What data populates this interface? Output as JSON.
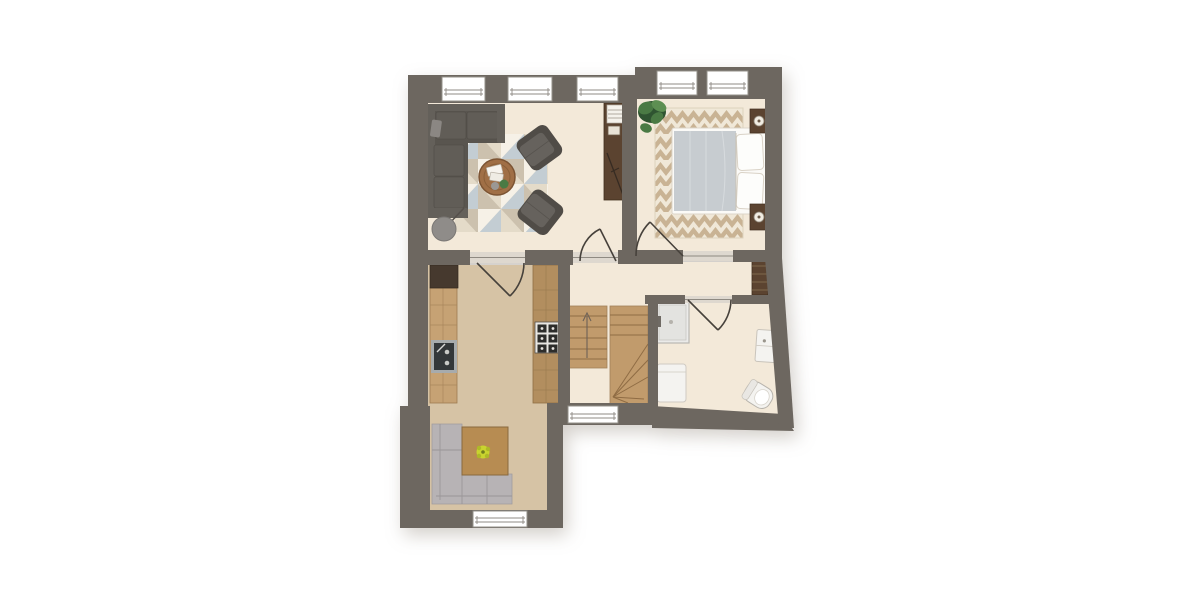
{
  "palette": {
    "background": "#ffffff",
    "wall": "#6d6760",
    "lintel": "#ded8cf",
    "jamb": "#8f8a82",
    "floor_cream": "#f3e9d9",
    "floor_tan": "#d6c3a5",
    "window_white": "#ffffff",
    "window_frame": "#94908a",
    "door_stroke": "#46413b",
    "stair_wood": "#c19b6c",
    "stair_line": "#8f6c44",
    "counter_wood": "#c6a274",
    "island_wood": "#b28e5f",
    "cabinet_dark": "#46392e",
    "sink_steel": "#a7abad",
    "sink_dark": "#33373a",
    "stove_panel": "#e8e6e2",
    "stove_dark": "#2d2d2b",
    "walnut": "#5b4330",
    "walnut_line": "#8a7356",
    "sofa_dark": "#59554f",
    "sofa_mid": "#615d57",
    "sofa_light": "#64605a",
    "sofa_pad": "#8b8783",
    "armchair_dark": "#504c47",
    "armchair_seat": "#66625d",
    "rug_white": "#f6f1e7",
    "rug_cream": "#e4dbc9",
    "rug_taupe": "#ccc1ae",
    "rug_blue": "#c3cdd3",
    "table_wood": "#a06f46",
    "table_edge": "#7c5433",
    "chevron_cream": "#f0e8d8",
    "chevron_beige": "#c9b394",
    "bed_frame": "#fbfaf7",
    "bed_frame_edge": "#dcd5c9",
    "duvet": "#c7ccd0",
    "duvet_fold": "#d7dbde",
    "pillow": "#fdfdfb",
    "bench_gray": "#b7b3b5",
    "bench_line": "#9a9698",
    "nook_table": "#b78c52",
    "flower_yellow": "#c9d42f",
    "flower_dark": "#717e1d",
    "plant_dark": "#2f5431",
    "plant_mid": "#4a7a44",
    "plant_light": "#5d8f52",
    "appliance_white": "#f4f3f0",
    "appliance_line": "#cfcac2",
    "fixture_fill": "#ebebe9",
    "fixture_stroke": "#bfbab2",
    "mixer_dark": "#6f6a64",
    "lamp_gray": "#8f8c89",
    "lamp_stem": "#55504b",
    "lamp_white": "#f1ece2",
    "lamp_dot": "#6b5b4a",
    "arrow": "#6d6257"
  },
  "plan": {
    "type": "apartment-floor-plan-top-view",
    "rooms": [
      "living-room",
      "bedroom",
      "kitchen",
      "dining-nook",
      "hallway",
      "stairwell",
      "bathroom"
    ],
    "window_count": 7,
    "door_count": 4,
    "furniture": {
      "living_room": [
        "corner-sofa",
        "triangle-pattern-rug",
        "round-coffee-table",
        "armchair-upper",
        "armchair-lower",
        "floor-lamp",
        "console-shelf"
      ],
      "bedroom": [
        "chevron-rug",
        "double-bed",
        "nightstand-upper",
        "nightstand-lower",
        "potted-plant"
      ],
      "kitchen": [
        "wall-counter",
        "tall-cabinet",
        "sink",
        "island-counter",
        "cooktop"
      ],
      "dining_nook": [
        "corner-bench",
        "dining-table",
        "flower-centerpiece"
      ],
      "hallway": [
        "wardrobe"
      ],
      "stairwell": [
        "straight-flight",
        "winder-flight",
        "direction-arrow"
      ],
      "bathroom": [
        "shower",
        "washing-machine",
        "wash-basin",
        "toilet"
      ]
    }
  }
}
